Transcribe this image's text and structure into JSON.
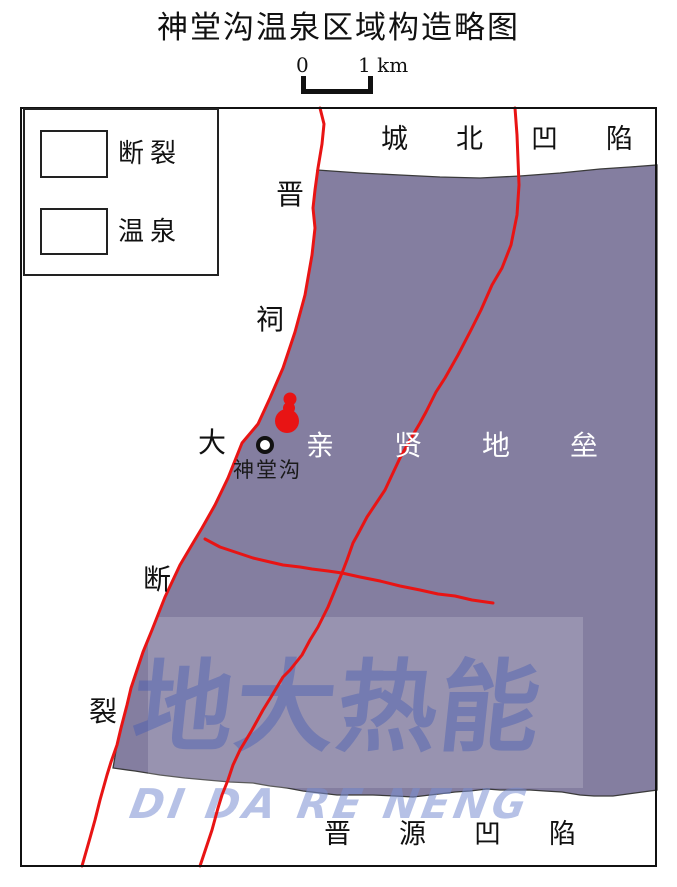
{
  "title": "神堂沟温泉区域构造略图",
  "scale": {
    "zero": "0",
    "label": "1 km"
  },
  "legend": {
    "fault": "断裂",
    "spring": "温泉"
  },
  "map": {
    "north_region": "城北凹陷",
    "horst_region": "亲贤地垒",
    "south_region": "晋源凹陷",
    "fault_name": "晋祠大断裂",
    "fault_chars": [
      "晋",
      "祠",
      "大",
      "断",
      "裂"
    ],
    "spring_site": "神堂沟"
  },
  "watermark": {
    "cn": "地大热能",
    "latin": "DI DA RE NENG"
  },
  "colors": {
    "horst": "#847EA0",
    "fault": "#E81414",
    "boundary": "#3A3A3A",
    "wmrect": "rgba(255,255,255,0.17)",
    "wmcn": "rgba(62,88,180,0.40)",
    "wmlatin": "rgba(122,142,210,0.55)"
  }
}
